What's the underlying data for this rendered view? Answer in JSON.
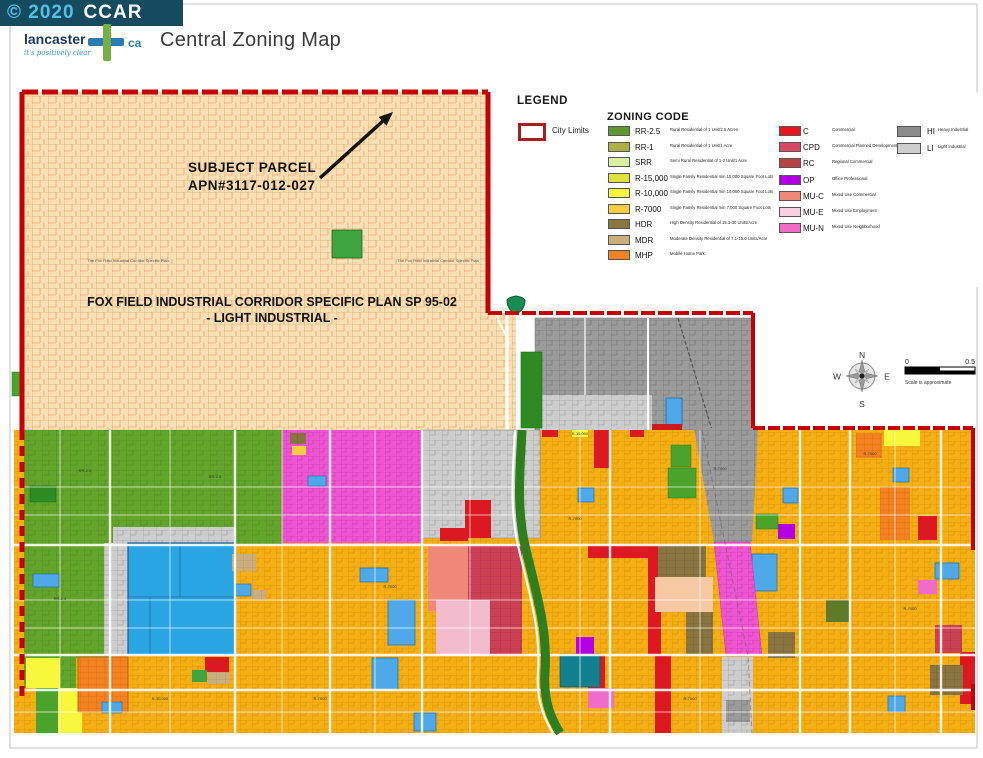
{
  "header": {
    "watermark": {
      "year_text": "© 2020",
      "brand": "CCAR"
    },
    "logo": {
      "name": "lancaster",
      "suffix": "ca",
      "tagline": "it's positively clear"
    },
    "title": "Central Zoning Map"
  },
  "legend": {
    "title": "LEGEND",
    "city_limits": {
      "label": "City Limits",
      "border_color": "#A81F1F"
    },
    "zoning_title": "ZONING CODE",
    "residential": [
      {
        "code": "RR-2.5",
        "color": "#5D9732",
        "desc": "Rural Residential of 1 Unit/2.5 Acres"
      },
      {
        "code": "RR-1",
        "color": "#ABB143",
        "desc": "Rural Residential of 1 Unit/1 Acre"
      },
      {
        "code": "SRR",
        "color": "#D9EFA6",
        "desc": "Semi Rural Residential of 1-2 Unit/1 Acre"
      },
      {
        "code": "R-15,000",
        "color": "#E0E23B",
        "desc": "Single Family Residential min 15,000 Square Foot Lots"
      },
      {
        "code": "R-10,000",
        "color": "#FBF73C",
        "desc": "Single Family Residential min 10,000 Square Foot Lots"
      },
      {
        "code": "R-7000",
        "color": "#FBCC3F",
        "desc": "Single Family Residential min 7,000 Square Foot Lots"
      },
      {
        "code": "HDR",
        "color": "#8A7440",
        "desc": "High Density Residential of 15.1-30 Units/Acre"
      },
      {
        "code": "MDR",
        "color": "#CBAD7E",
        "desc": "Moderate Density Residential of 7.1-15.0 Units/Acre"
      },
      {
        "code": "MHP",
        "color": "#F58220",
        "desc": "Mobile Home Park"
      }
    ],
    "commercial": [
      {
        "code": "C",
        "color": "#E8141E",
        "desc": "Commercial"
      },
      {
        "code": "CPD",
        "color": "#D94860",
        "desc": "Commercial Planned Development"
      },
      {
        "code": "RC",
        "color": "#B94343",
        "desc": "Regional Commercial"
      },
      {
        "code": "OP",
        "color": "#B400E6",
        "desc": "Office Professional"
      },
      {
        "code": "MU-C",
        "color": "#EF8878",
        "desc": "Mixed Use Commercial"
      },
      {
        "code": "MU-E",
        "color": "#F8CFE0",
        "desc": "Mixed Use Employment"
      },
      {
        "code": "MU-N",
        "color": "#F06CC8",
        "desc": "Mixed Use Neighborhood"
      }
    ],
    "industrial": [
      {
        "code": "HI",
        "color": "#8C8C8C",
        "desc": "Heavy Industrial"
      },
      {
        "code": "LI",
        "color": "#CFCFCF",
        "desc": "Light Industrial"
      }
    ]
  },
  "map": {
    "city_limits_color": "#C60000",
    "annotations": {
      "subject_parcel_line1": "SUBJECT PARCEL",
      "subject_parcel_line2": "APN#3117-012-027",
      "specific_plan_line1": "FOX FIELD INDUSTRIAL  CORRIDOR  SPECIFIC PLAN  SP 95-02",
      "specific_plan_line2": "- LIGHT INDUSTRIAL -",
      "specific_plan_note": "The Fox Field Industrial Corridor Specific Plan"
    },
    "parcel_labels": [
      {
        "text": "RR-2.5",
        "x": 85,
        "y": 472
      },
      {
        "text": "RR-2.5",
        "x": 215,
        "y": 478
      },
      {
        "text": "RR-2.5",
        "x": 60,
        "y": 600
      },
      {
        "text": "R-15,000",
        "x": 580,
        "y": 435
      },
      {
        "text": "R-7000",
        "x": 390,
        "y": 588
      },
      {
        "text": "R-7000",
        "x": 575,
        "y": 520
      },
      {
        "text": "R-7000",
        "x": 720,
        "y": 470
      },
      {
        "text": "R-7000",
        "x": 870,
        "y": 455
      },
      {
        "text": "R-7000",
        "x": 910,
        "y": 610
      },
      {
        "text": "R-7000",
        "x": 320,
        "y": 700
      },
      {
        "text": "R-7000",
        "x": 690,
        "y": 700
      },
      {
        "text": "R-10,000",
        "x": 160,
        "y": 700
      }
    ],
    "compass": {
      "north": "N",
      "south": "S",
      "east": "E",
      "west": "W"
    },
    "scale": {
      "start": "0",
      "end": "0.5",
      "note": "Scale is approximate"
    }
  }
}
